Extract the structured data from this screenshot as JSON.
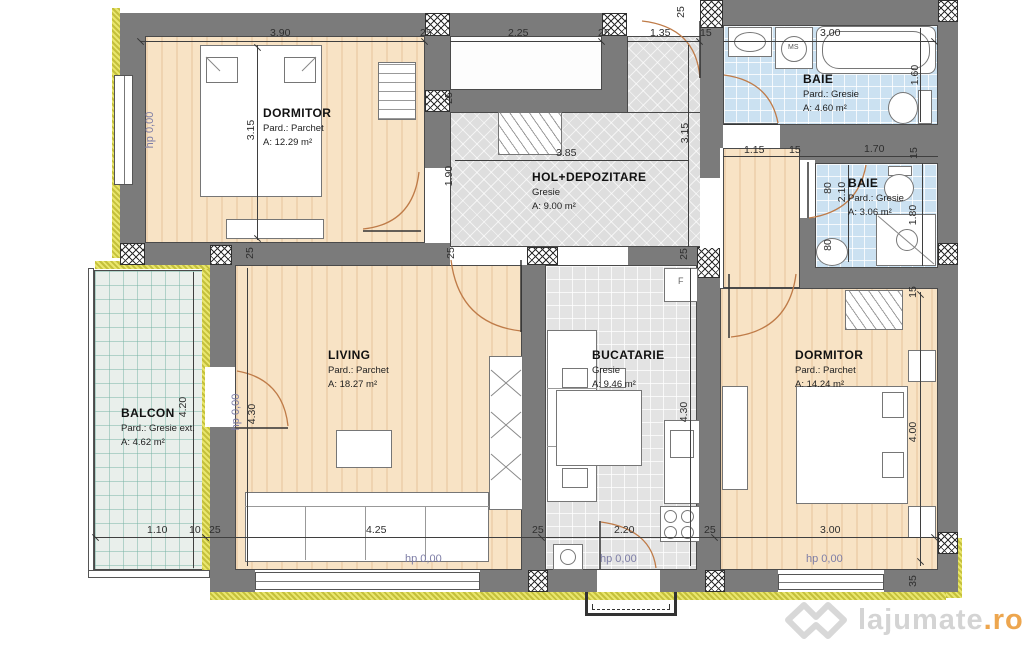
{
  "rooms": {
    "dormitor1": {
      "name": "DORMITOR",
      "floor": "Pard.: Parchet",
      "area": "A: 12.29 m²"
    },
    "baie1": {
      "name": "BAIE",
      "floor": "Pard.: Gresie",
      "area": "A: 4.60 m²"
    },
    "baie2": {
      "name": "BAIE",
      "floor": "Pard.: Gresie",
      "area": "A: 3.06 m²"
    },
    "hol": {
      "name": "HOL+DEPOZITARE",
      "floor": "Gresie",
      "area": "A: 9.00 m²"
    },
    "living": {
      "name": "LIVING",
      "floor": "Pard.: Parchet",
      "area": "A: 18.27 m²"
    },
    "bucatarie": {
      "name": "BUCATARIE",
      "floor": "Gresie",
      "area": "A: 9.46 m²"
    },
    "dormitor2": {
      "name": "DORMITOR",
      "floor": "Pard.: Parchet",
      "area": "A: 14.24 m²"
    },
    "balcon": {
      "name": "BALCON",
      "floor": "Pard.: Gresie ext.",
      "area": "A: 4.62 m²"
    }
  },
  "dims": {
    "d390": "3.90",
    "d225": "2.25",
    "d135": "1.35",
    "d300": "3.00",
    "d315": "3.15",
    "d160": "1.60",
    "d115": "1.15",
    "d170": "1.70",
    "d385": "3.85",
    "d190": "1.90",
    "d210": "2.10",
    "d180": "1.80",
    "d425": "4.25",
    "d220": "2.20",
    "d430": "4.30",
    "d400": "4.00",
    "d420": "4.20",
    "d110": "1.10",
    "d10": "10",
    "d25": "25",
    "d15": "15",
    "d80": "80",
    "d35": "35"
  },
  "labels": {
    "hp": "hp 0,00",
    "ms": "MS",
    "f": "F"
  },
  "watermark": {
    "name": "lajumate",
    "tld": ".ro"
  },
  "colors": {
    "wall": "#7b7b7b",
    "insulation": "#e9e66d",
    "parquet": "#f8e3c5",
    "bath_tile": "#cbe1f1",
    "hall_tile": "#dedede",
    "balcony_tile": "#e9efeb",
    "dim_text": "#2e2e2e",
    "hp_text": "#7d7da6",
    "door_arc": "#bf7b48",
    "watermark_gray": "#d4d4d4",
    "watermark_orange": "#eda64f"
  }
}
